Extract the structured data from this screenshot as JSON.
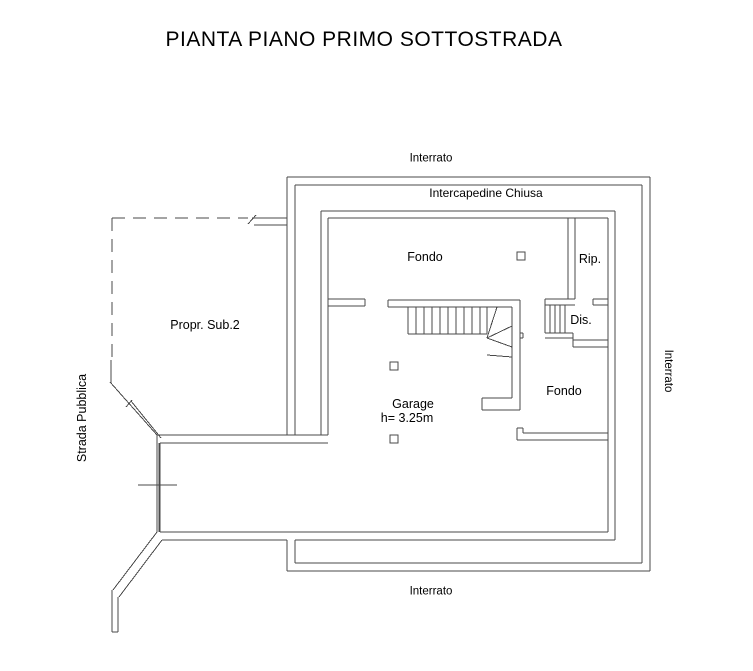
{
  "title": "PIANTA PIANO PRIMO SOTTOSTRADA",
  "labels": {
    "interrato_top": "Interrato",
    "intercapedine_chiusa": "Intercapedine Chiusa",
    "fondo_top": "Fondo",
    "rip": "Rip.",
    "dis": "Dis.",
    "propr_sub2": "Propr. Sub.2",
    "strada_pubblica": "Strada Pubblica",
    "garage": "Garage",
    "garage_height": "h= 3.25m",
    "fondo_right": "Fondo",
    "interrato_right": "Interrato",
    "interrato_bottom": "Interrato"
  },
  "rooms": [
    {
      "name": "Fondo",
      "note": ""
    },
    {
      "name": "Rip.",
      "note": ""
    },
    {
      "name": "Dis.",
      "note": ""
    },
    {
      "name": "Garage",
      "note": "h= 3.25m"
    },
    {
      "name": "Fondo",
      "note": ""
    },
    {
      "name": "Propr. Sub.2",
      "note": ""
    }
  ],
  "colors": {
    "background": "#ffffff",
    "line": "#4a4a4a",
    "text": "#000000"
  }
}
